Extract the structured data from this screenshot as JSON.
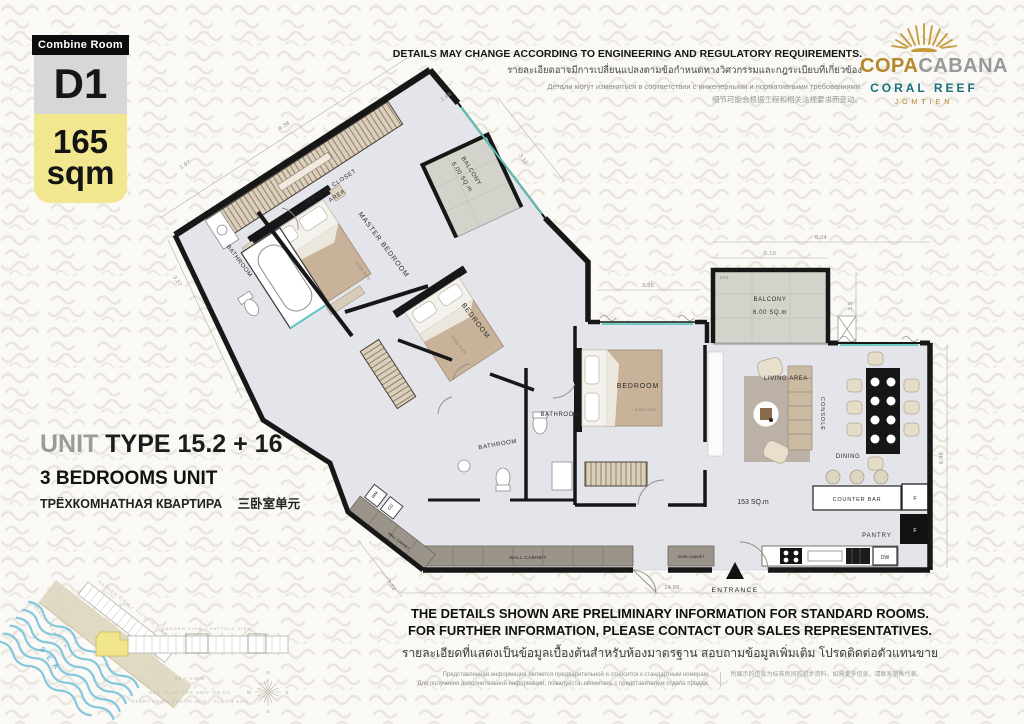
{
  "badge": {
    "tag": "Combine Room",
    "code": "D1",
    "area_value": "165",
    "area_unit": "sqm"
  },
  "logo": {
    "word_left": "COPA",
    "word_right": "CABANA",
    "subtitle": "CORAL REEF",
    "location": "JOMTIEN"
  },
  "disclaimer_top": {
    "en": "DETAILS MAY CHANGE ACCORDING TO ENGINEERING AND REGULATORY REQUIREMENTS.",
    "th": "รายละเอียดอาจมีการเปลี่ยนแปลงตามข้อกำหนดทางวิศวกรรมและกฎระเบียบที่เกี่ยวข้อง",
    "ru": "Детали могут изменяться в соответствии с инженерными и нормативными требованиями.",
    "zh": "细节可能会根据工程和相关法规要求而变动。"
  },
  "unit_info": {
    "prefix": "UNIT",
    "type": "TYPE 15.2 + 16",
    "bedrooms_en": "3 BEDROOMS UNIT",
    "bedrooms_ru": "ТРЁХКОМНАТНАЯ КВАРТИРА",
    "bedrooms_zh": "三卧室单元"
  },
  "plan": {
    "total_area": "153 SQ.m",
    "labels": {
      "walk_in_closet": "WALK-IN CLOSET",
      "walk_in_closet_area": "AREA",
      "bathroom_master": "BATHROOM",
      "master_bedroom": "MASTER BEDROOM",
      "master_bed_size": "KING SIZE",
      "bedroom_2": "BEDROOM",
      "bedroom_2_size": "KING SIZE",
      "bathroom_2": "BATHROOM",
      "bathroom_3": "BATHROOM",
      "bedroom_3": "BEDROOM",
      "bedroom_3_size": "KING SIZE",
      "living_area": "LIVING AREA",
      "console": "CONSOLE",
      "dining": "DINING",
      "counter_bar": "COUNTER BAR",
      "pantry": "PANTRY",
      "fridge": "F",
      "freezer": "F",
      "dishwasher": "DW",
      "washing_machine": "WM",
      "clothes_dryer": "CD",
      "wall_cabinet_1": "WALL CABINET",
      "wall_cabinet_2": "WALL CABINET",
      "shoe_cabinet": "SHOE CABINET",
      "entrance": "ENTRANCE",
      "balcony_1": "BALCONY",
      "balcony_1_area": "6.00 SQ.m",
      "balcony_2": "BALCONY",
      "balcony_2_area": "6.00 SQ.m",
      "spd": "SPD."
    },
    "dimensions": {
      "end_wall": "4.38",
      "left_1": "1.97",
      "left_2": "3.57",
      "balcony1_top": "1.95",
      "balcony1_side": "3.10",
      "bedroom3_window": "3.36",
      "balcony2_width": "5.10",
      "living_top": "6.04",
      "balcony2_gap": "1.5",
      "right_side": "6.48",
      "bottom": "14.88",
      "bottom_left": "3.23"
    }
  },
  "key_plan": {
    "sea": "S E A",
    "direct_sea_view": "DIRECT SEA VIEW",
    "garden_view_diagonal": "GARDEN VIEW / PATTAYA VIEW",
    "garden_view_horizontal": "GARDEN VIEW / PATTAYA VIEW",
    "sea_view": "SEA VIEW",
    "caption_line1": "KEY PLAN FOR UNIT ON D1",
    "caption_line2": "START FROM FLOOR 40th - FLOOR 54th",
    "compass": {
      "n": "N",
      "e": "E",
      "s": "S",
      "w": "W"
    }
  },
  "disclaimer_bottom": {
    "en_line1": "THE DETAILS SHOWN ARE PRELIMINARY INFORMATION FOR STANDARD ROOMS.",
    "en_line2": "FOR FURTHER INFORMATION, PLEASE CONTACT OUR SALES REPRESENTATIVES.",
    "th": "รายละเอียดที่แสดงเป็นข้อมูลเบื้องต้นสำหรับห้องมาตรฐาน สอบถามข้อมูลเพิ่มเติม โปรดติดต่อตัวแทนขาย",
    "ru_line1": "Представленная информация является предварительной и относится к стандартным номерам.",
    "ru_line2": "Для получения дополнительной информации, пожалуйста, свяжитесь с представителем отдела продаж.",
    "zh": "所展示的信息为标准房间的初步资料，如需更多信息，请联系销售代表。"
  },
  "colors": {
    "accent_yellow": "#f1e78e",
    "logo_gold": "#b6862c",
    "logo_silver": "#97989a",
    "coral_teal": "#16707e",
    "wall_black": "#171717",
    "floor": "#e4e5eb",
    "balcony": "#d2d3ca",
    "window_teal": "#5fc6bd",
    "sea_blue": "#85c8de"
  }
}
